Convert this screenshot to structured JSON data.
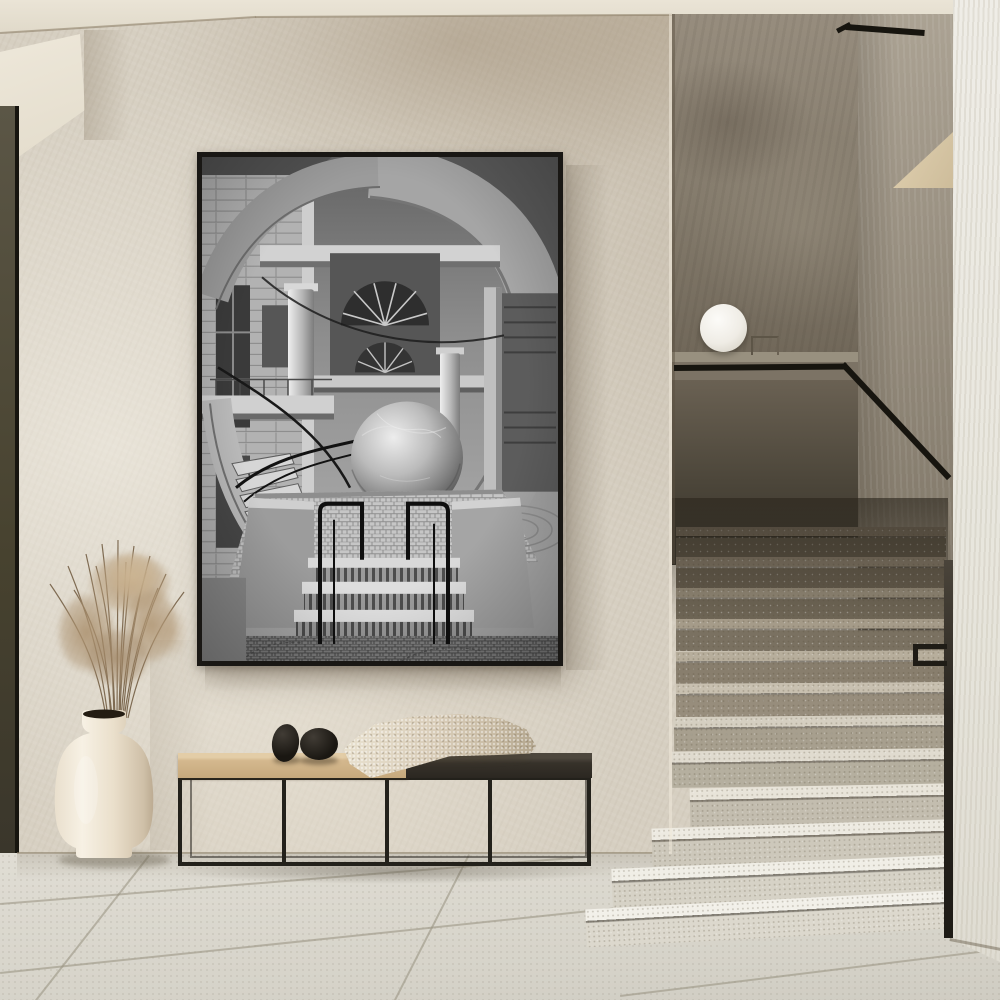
{
  "scene": {
    "setting": "Minimalist plaster hallway with a large framed black-and-white brutalist architecture print above a low bench, a cream vase of dried pampas grass, and a terrazzo staircase with a glass globe lamp",
    "wall_art": {
      "name": "framed-print",
      "frame_color": "#191714",
      "subject": "Black-and-white photograph of a brutalist atrium: sweeping spiral staircase, concrete columns, vaulted core, large cracked stone sphere sculpture, mosaic plaza and twin black handrails over wide steps"
    },
    "lamp": {
      "name": "globe-lamp",
      "color": "#f6f4ef"
    },
    "bench": {
      "name": "metal-frame-bench",
      "wood_color": "#cfae83",
      "dark_top_color": "#332e27",
      "frame_color": "#23211b",
      "decor": [
        "black-egg-stone",
        "black-round-stone",
        "folded-knit-throw"
      ]
    },
    "vase": {
      "name": "cream-ceramic-vase",
      "color": "#efe7d8",
      "contents": "dried pampas grass"
    },
    "staircase": {
      "name": "terrazzo-staircase",
      "handrail_color": "#17150f",
      "steps": [
        {
          "x": 676,
          "y": 527,
          "w": 270,
          "h": 30,
          "tread": "#776c5c",
          "riser": "#5a5244",
          "rot": 0
        },
        {
          "x": 676,
          "y": 557,
          "w": 270,
          "h": 31,
          "tread": "#857a69",
          "riser": "#655c4d",
          "rot": 0
        },
        {
          "x": 676,
          "y": 588,
          "w": 270,
          "h": 31,
          "tread": "#948a78",
          "riser": "#6f6656",
          "rot": 0
        },
        {
          "x": 676,
          "y": 619,
          "w": 270,
          "h": 32,
          "tread": "#a59b89",
          "riser": "#7a7161",
          "rot": 0
        },
        {
          "x": 676,
          "y": 651,
          "w": 270,
          "h": 32,
          "tread": "#b7ae9c",
          "riser": "#887e6d",
          "rot": -0.3
        },
        {
          "x": 676,
          "y": 683,
          "w": 270,
          "h": 33,
          "tread": "#c8c0b0",
          "riser": "#978d7c",
          "rot": -0.4
        },
        {
          "x": 674,
          "y": 716,
          "w": 272,
          "h": 34,
          "tread": "#d5cfc1",
          "riser": "#a79f8e",
          "rot": -0.6
        },
        {
          "x": 672,
          "y": 750,
          "w": 274,
          "h": 36,
          "tread": "#e0dbcf",
          "riser": "#b5af9f",
          "rot": -0.8
        },
        {
          "x": 690,
          "y": 786,
          "w": 256,
          "h": 38,
          "tread": "#e8e4d9",
          "riser": "#c3bdaf",
          "rot": -1.2
        },
        {
          "x": 652,
          "y": 824,
          "w": 294,
          "h": 38,
          "tread": "#edeae1",
          "riser": "#cdc8bb",
          "rot": -1.8
        },
        {
          "x": 612,
          "y": 862,
          "w": 334,
          "h": 40,
          "tread": "#f0eee6",
          "riser": "#d6d2c6",
          "rot": -2.4
        },
        {
          "x": 586,
          "y": 900,
          "w": 360,
          "h": 38,
          "tread": "#f2f0e9",
          "riser": "#dcd8cd",
          "rot": -3.0
        }
      ]
    },
    "palette": {
      "wall": "#d6cfc1",
      "ceiling": "#e8e2d4",
      "floor": "#dcd9d0",
      "door_edge": "#47422f",
      "stair_shadow_wall": "#4c463a",
      "right_wall": "#ebe9e2"
    }
  }
}
